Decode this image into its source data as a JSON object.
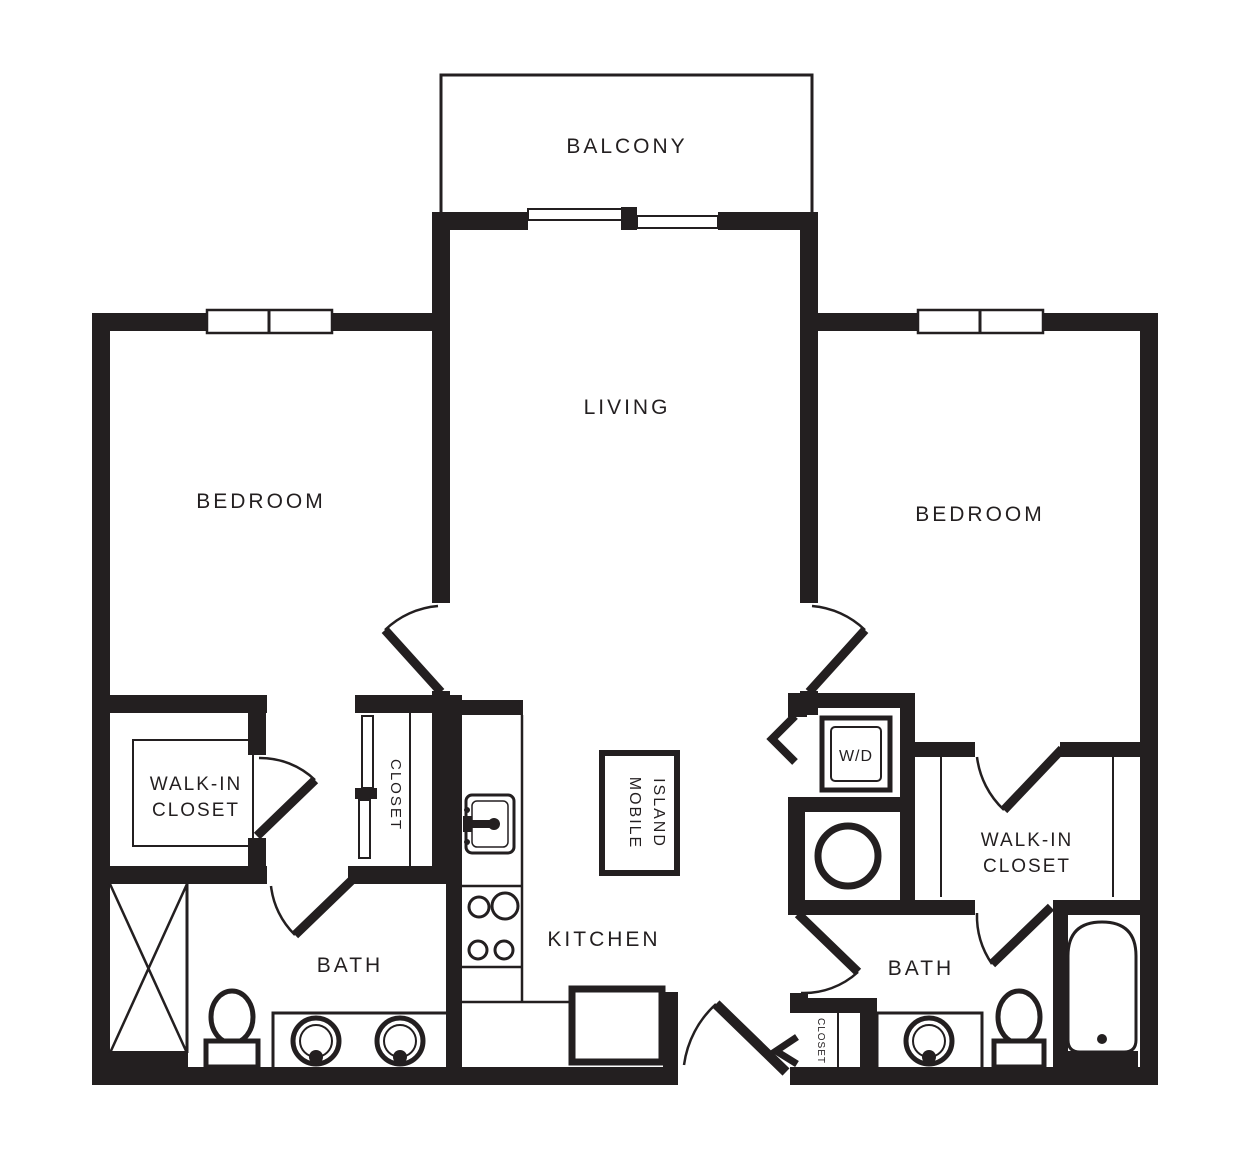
{
  "title": "Two Bedroom Two Bath Apartment Floor Plan",
  "colors": {
    "ink": "#231F20",
    "paper": "#FFFFFF"
  },
  "rooms": {
    "balcony": "BALCONY",
    "living": "LIVING",
    "bedroom_left": "BEDROOM",
    "bedroom_right": "BEDROOM",
    "kitchen": "KITCHEN",
    "bath_left": "BATH",
    "bath_right": "BATH",
    "walk_in_closet_left": {
      "line1": "WALK-IN",
      "line2": "CLOSET"
    },
    "walk_in_closet_right": {
      "line1": "WALK-IN",
      "line2": "CLOSET"
    },
    "hall_closet": "CLOSET",
    "entry_closet": "CLOSET"
  },
  "fixtures": {
    "mobile_island": {
      "line1": "MOBILE",
      "line2": "ISLAND"
    },
    "washer_dryer": "W/D"
  }
}
